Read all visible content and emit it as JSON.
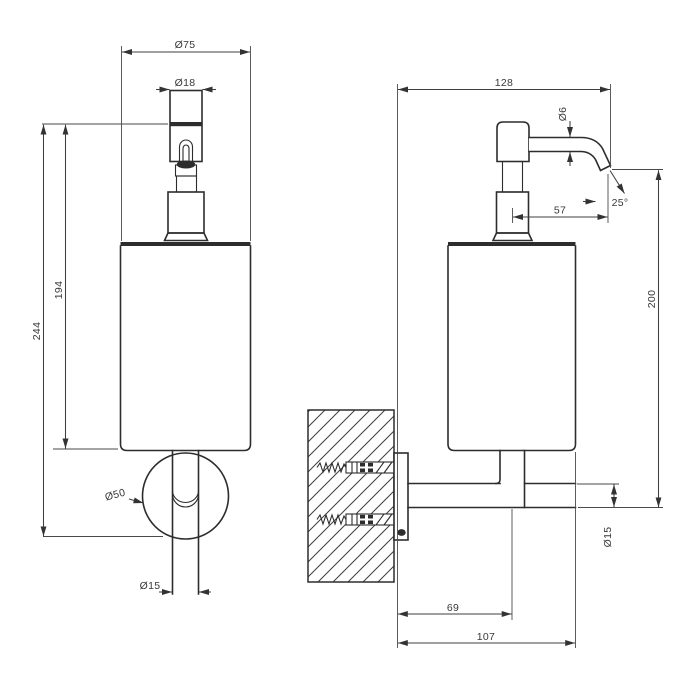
{
  "drawing": {
    "colors": {
      "background": "#ffffff",
      "line_color": "#2d2d2d",
      "dim_color": "#3f3f3f",
      "text_color": "#383838"
    },
    "views": {
      "front": {
        "dims": {
          "diameter_body": "Ø75",
          "diameter_pump": "Ø18",
          "height_pump_to_body_bottom": "194",
          "height_pump_to_flange_bottom": "244",
          "diameter_flange": "Ø50",
          "diameter_arm": "Ø15"
        }
      },
      "side": {
        "dims": {
          "depth_wall_to_spout": "128",
          "diameter_spout": "Ø6",
          "spout_angle": "25°",
          "spout_reach": "57",
          "height_spout_to_arm": "200",
          "diameter_arm": "Ø15",
          "wall_to_arm_center": "69",
          "wall_to_body_edge": "107"
        }
      }
    }
  }
}
